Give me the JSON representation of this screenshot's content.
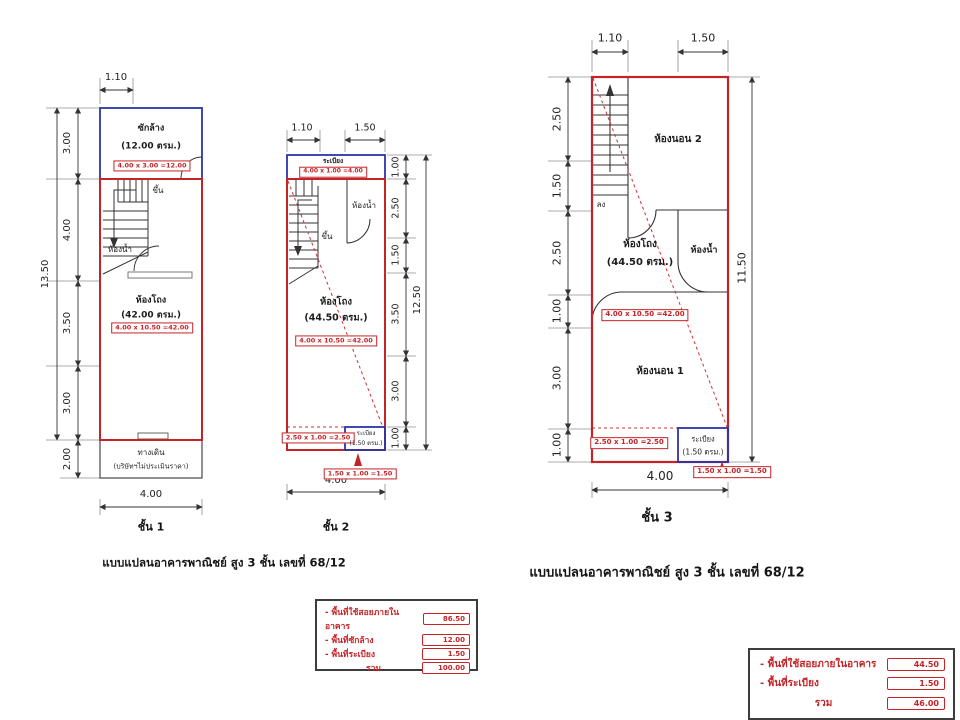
{
  "colors": {
    "assessed_outline_red": "#c42427",
    "unassessed_outline_blue": "#2a35a8"
  },
  "captions": {
    "left": "แบบแปลนอาคารพาณิชย์ สูง 3 ชั้น เลขที่ 68/12",
    "right": "แบบแปลนอาคารพาณิชย์ สูง 3 ชั้น เลขที่ 68/12"
  },
  "floor1": {
    "label": "ชั้น 1",
    "laundry": {
      "name": "ซักล้าง",
      "area": "(12.00 ตรม.)",
      "calc": "4.00 x 3.00 =12.00"
    },
    "hall": {
      "name": "ห้องโถง",
      "area": "(42.00 ตรม.)",
      "calc": "4.00 x 10.50 =42.00"
    },
    "stair": "ขึ้น",
    "bath": "ห้องน้ำ",
    "walkway": {
      "name": "ทางเดิน",
      "note": "(บริษัทฯไม่ประเมินราคา)"
    },
    "dims": {
      "top": "1.10",
      "left_total": "13.50",
      "left": [
        "3.00",
        "4.00",
        "3.50",
        "3.00",
        "2.00"
      ],
      "bottom": "4.00"
    }
  },
  "floor2": {
    "label": "ชั้น 2",
    "balcony_top": {
      "name": "ระเบียง",
      "calc": "4.00 x 1.00 =4.00"
    },
    "hall": {
      "name": "ห้องโถง",
      "area": "(44.50 ตรม.)",
      "calc": "4.00 x 10.50 =42.00",
      "calc2": "2.50 x 1.00 =2.50"
    },
    "stair": "ขึ้น",
    "bath": "ห้องน้ำ",
    "balcony": {
      "name": "ระเบียง",
      "area": "(1.50 ตรม.)",
      "calc": "1.50 x 1.00 =1.50"
    },
    "dims": {
      "top": [
        "1.10",
        "1.50"
      ],
      "right": [
        "1.00",
        "2.50",
        "1.50",
        "3.50",
        "3.00",
        "1.00"
      ],
      "right_total": "12.50",
      "bottom": "4.00"
    }
  },
  "floor3": {
    "label": "ชั้น 3",
    "bedroom2": "ห้องนอน 2",
    "stair": "ลง",
    "hall": {
      "name": "ห้องโถง",
      "area": "(44.50 ตรม.)",
      "calc": "4.00 x 10.50 =42.00",
      "calc2": "2.50 x 1.00 =2.50"
    },
    "bath": "ห้องน้ำ",
    "bedroom1": "ห้องนอน 1",
    "balcony": {
      "name": "ระเบียง",
      "area": "(1.50 ตรม.)",
      "calc": "1.50 x 1.00 =1.50"
    },
    "dims": {
      "top": [
        "1.10",
        "1.50"
      ],
      "left": [
        "2.50",
        "1.50",
        "2.50",
        "1.00",
        "3.00",
        "1.00"
      ],
      "right_total": "11.50",
      "bottom": "4.00"
    }
  },
  "summary_left": {
    "rows": [
      {
        "label": "- พื้นที่ใช้สอยภายในอาคาร",
        "value": "86.50"
      },
      {
        "label": "- พื้นที่ซักล้าง",
        "value": "12.00"
      },
      {
        "label": "- พื้นที่ระเบียง",
        "value": "1.50"
      },
      {
        "label": "รวม",
        "value": "100.00"
      }
    ]
  },
  "summary_right": {
    "rows": [
      {
        "label": "- พื้นที่ใช้สอยภายในอาคาร",
        "value": "44.50"
      },
      {
        "label": "- พื้นที่ระเบียง",
        "value": "1.50"
      },
      {
        "label": "รวม",
        "value": "46.00"
      }
    ]
  }
}
